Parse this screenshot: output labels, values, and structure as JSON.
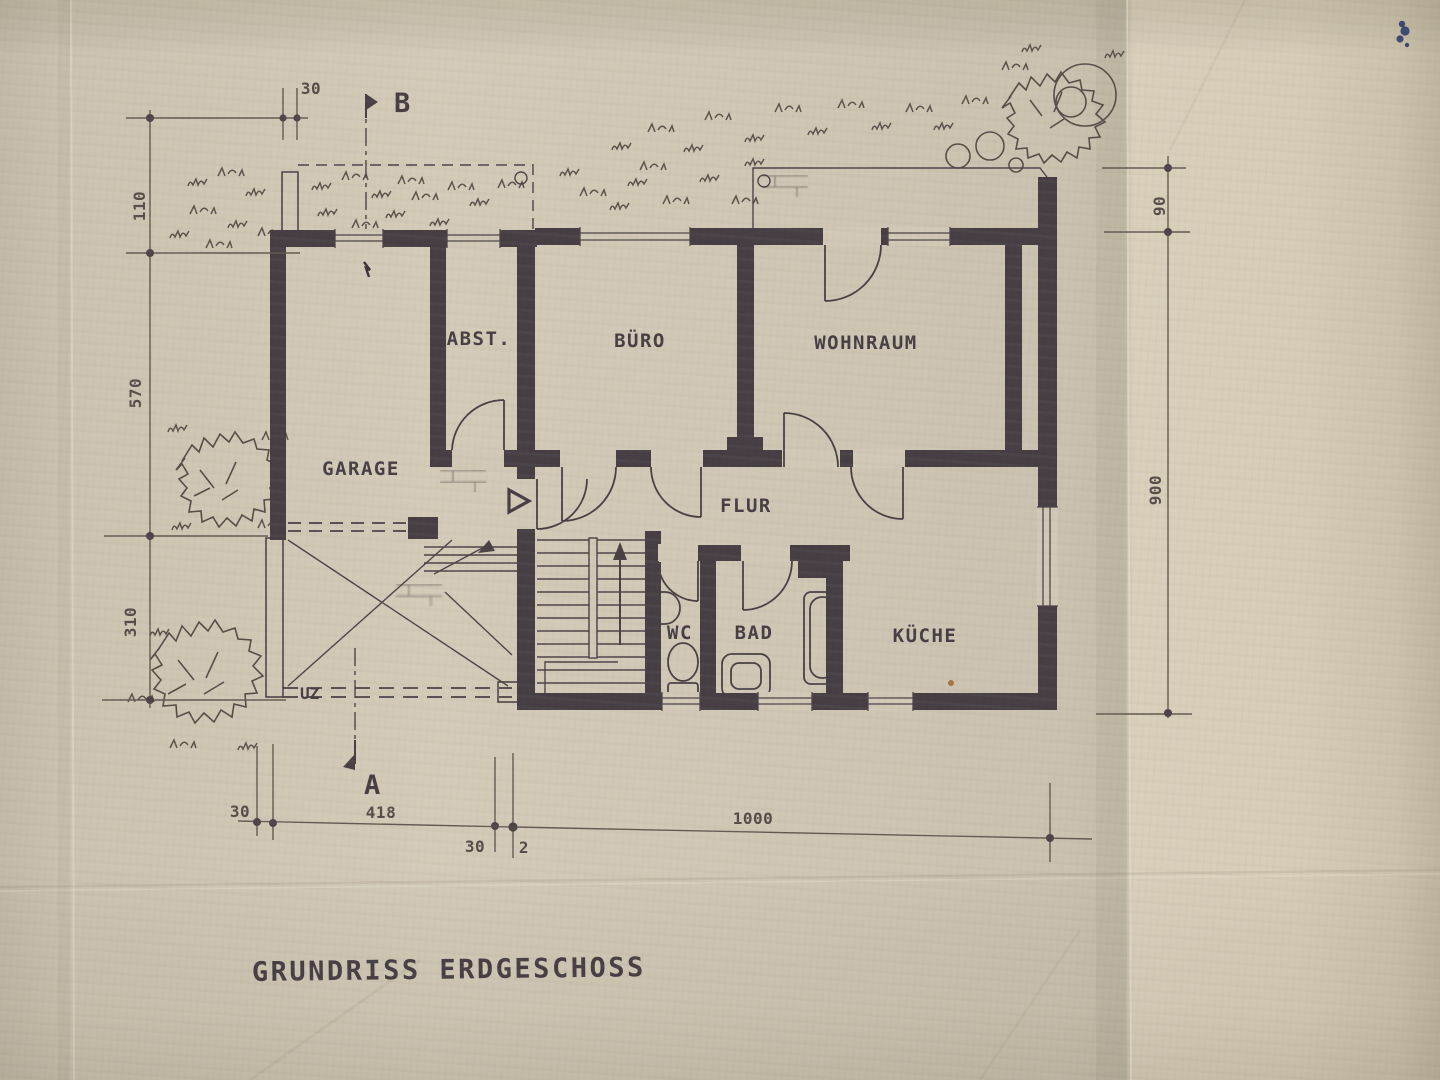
{
  "title": "GRUNDRISS ERDGESCHOSS",
  "plan": {
    "rooms": [
      {
        "id": "garage",
        "label": "GARAGE"
      },
      {
        "id": "abst",
        "label": "ABST."
      },
      {
        "id": "buero",
        "label": "BÜRO"
      },
      {
        "id": "wohnraum",
        "label": "WOHNRAUM"
      },
      {
        "id": "flur",
        "label": "FLUR"
      },
      {
        "id": "wc",
        "label": "WC"
      },
      {
        "id": "bad",
        "label": "BAD"
      },
      {
        "id": "kueche",
        "label": "KÜCHE"
      }
    ],
    "annotations": {
      "uz": "UZ",
      "section_a": "A",
      "section_b": "B"
    },
    "dimensions": {
      "top_left": "30",
      "left": [
        "110",
        "570",
        "310"
      ],
      "right": [
        "90",
        "900"
      ],
      "bottom": [
        "30",
        "418",
        "30",
        "2",
        "1000"
      ]
    }
  },
  "colors": {
    "paper": "#cfc7b4",
    "paper_right": "#d9cfbb",
    "ink": "#473f44",
    "pencil": "#655a52"
  }
}
